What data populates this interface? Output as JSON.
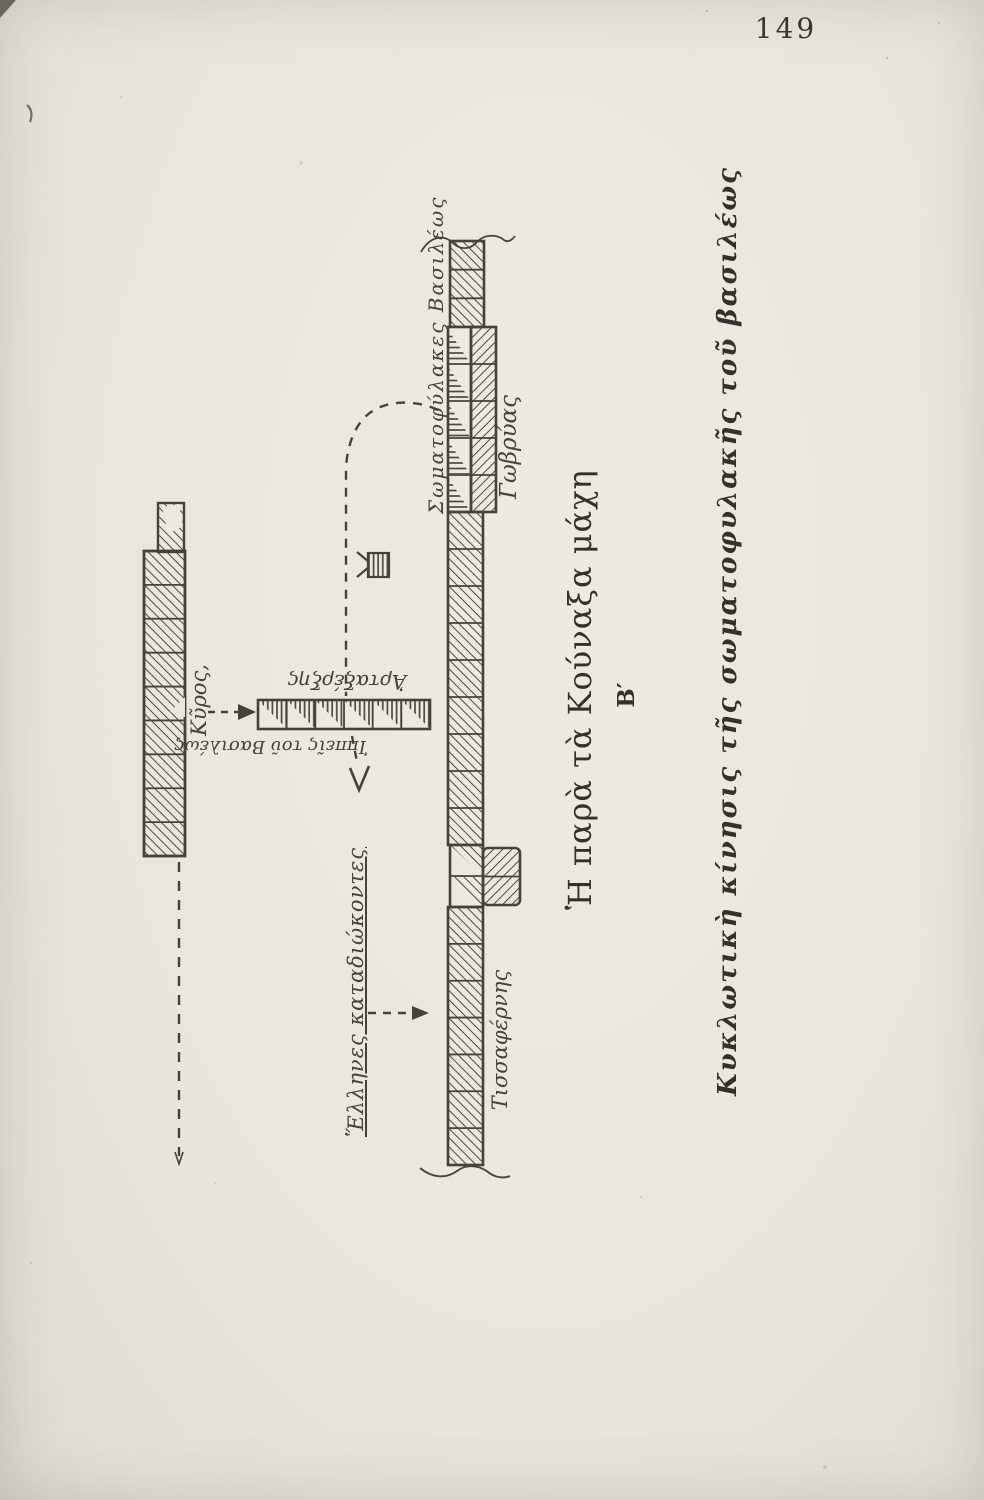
{
  "page": {
    "number": "149"
  },
  "captions": {
    "title": "Ἡ παρὰ τὰ Κούναξα μάχη",
    "section_letter": "Β′",
    "subtitle": "Κυκλωτικὴ κίνησις τῆς σωματοφυλακῆς τοῦ βασιλέως"
  },
  "diagram": {
    "labels": {
      "royal_guard": "Σωματοφύλακες Βασιλέως",
      "gobryas": "Γωβρύας",
      "tissaphernes": "Τισσαφέρνης",
      "cyrus": "Κῦρος,",
      "artaxerxes": "Ἀρταξέρξης",
      "kings_cavalry": "Ἱππεῖς τοῦ Βασιλέως",
      "greeks_pursuing": "Ἕλληνες καταδιώκοντες"
    },
    "symbols": {
      "kings_standard": "flag-marker",
      "encircling_route": "dashed-curve-with-arrow",
      "cyrus_attack": "dashed-arrow-right",
      "greek_pursuit_line": "dashed-line-down",
      "greek_pursuit_arrow": "dashed-arrow-right"
    }
  },
  "colors": {
    "paper": "#e9e6df",
    "ink": "#45423a",
    "print_ink": "#33312b"
  }
}
